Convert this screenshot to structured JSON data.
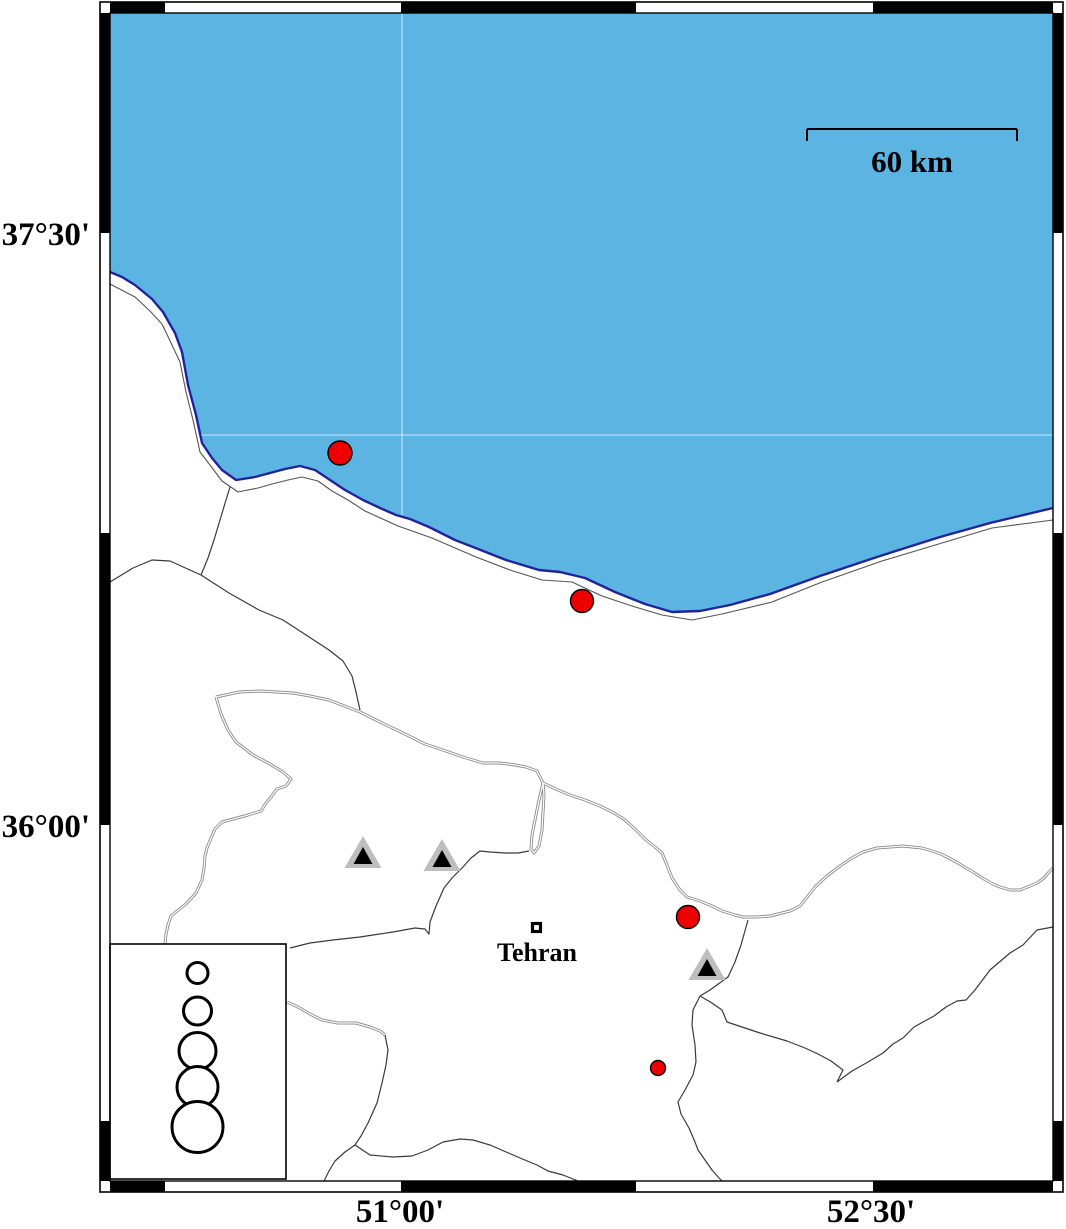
{
  "map": {
    "title_hint": "Caspian coast / Tehran region seismicity map",
    "colors": {
      "sea_fill": "#5CB4E3",
      "coast_stroke": "#22229B",
      "epicenter_fill": "#EE0000",
      "epicenter_stroke": "#000000",
      "triangle_outer": "#BEBEBE",
      "triangle_inner": "#000000",
      "boundary": "#3a3a3a",
      "gridline": "rgba(255,255,255,0.55)"
    },
    "axis_labels": {
      "lat": [
        {
          "text": "37°30'",
          "y": 233
        },
        {
          "text": "36°00'",
          "y": 825
        }
      ],
      "lon": [
        {
          "text": "51°00'",
          "x": 400
        },
        {
          "text": "52°30'",
          "x": 871
        }
      ]
    },
    "scale_bar": {
      "label": "60 km",
      "x1": 807,
      "x2": 1017,
      "y": 129
    },
    "city": {
      "name": "Tehran",
      "x": 537,
      "y": 934
    },
    "epicenters": [
      {
        "x": 340,
        "y": 453,
        "r": 12
      },
      {
        "x": 582,
        "y": 601,
        "r": 11.5
      },
      {
        "x": 688,
        "y": 917,
        "r": 11.5
      },
      {
        "x": 658,
        "y": 1068,
        "r": 7.5
      }
    ],
    "stations": [
      {
        "x": 363,
        "y": 855
      },
      {
        "x": 442,
        "y": 858
      },
      {
        "x": 707,
        "y": 967
      }
    ],
    "legend": {
      "cx": 197.5,
      "circles": [
        {
          "cy": 973,
          "r": 10.5
        },
        {
          "cy": 1011,
          "r": 14
        },
        {
          "cy": 1051,
          "r": 18.5
        },
        {
          "cy": 1087,
          "r": 20.5
        },
        {
          "cy": 1127,
          "r": 25.5
        }
      ]
    }
  }
}
